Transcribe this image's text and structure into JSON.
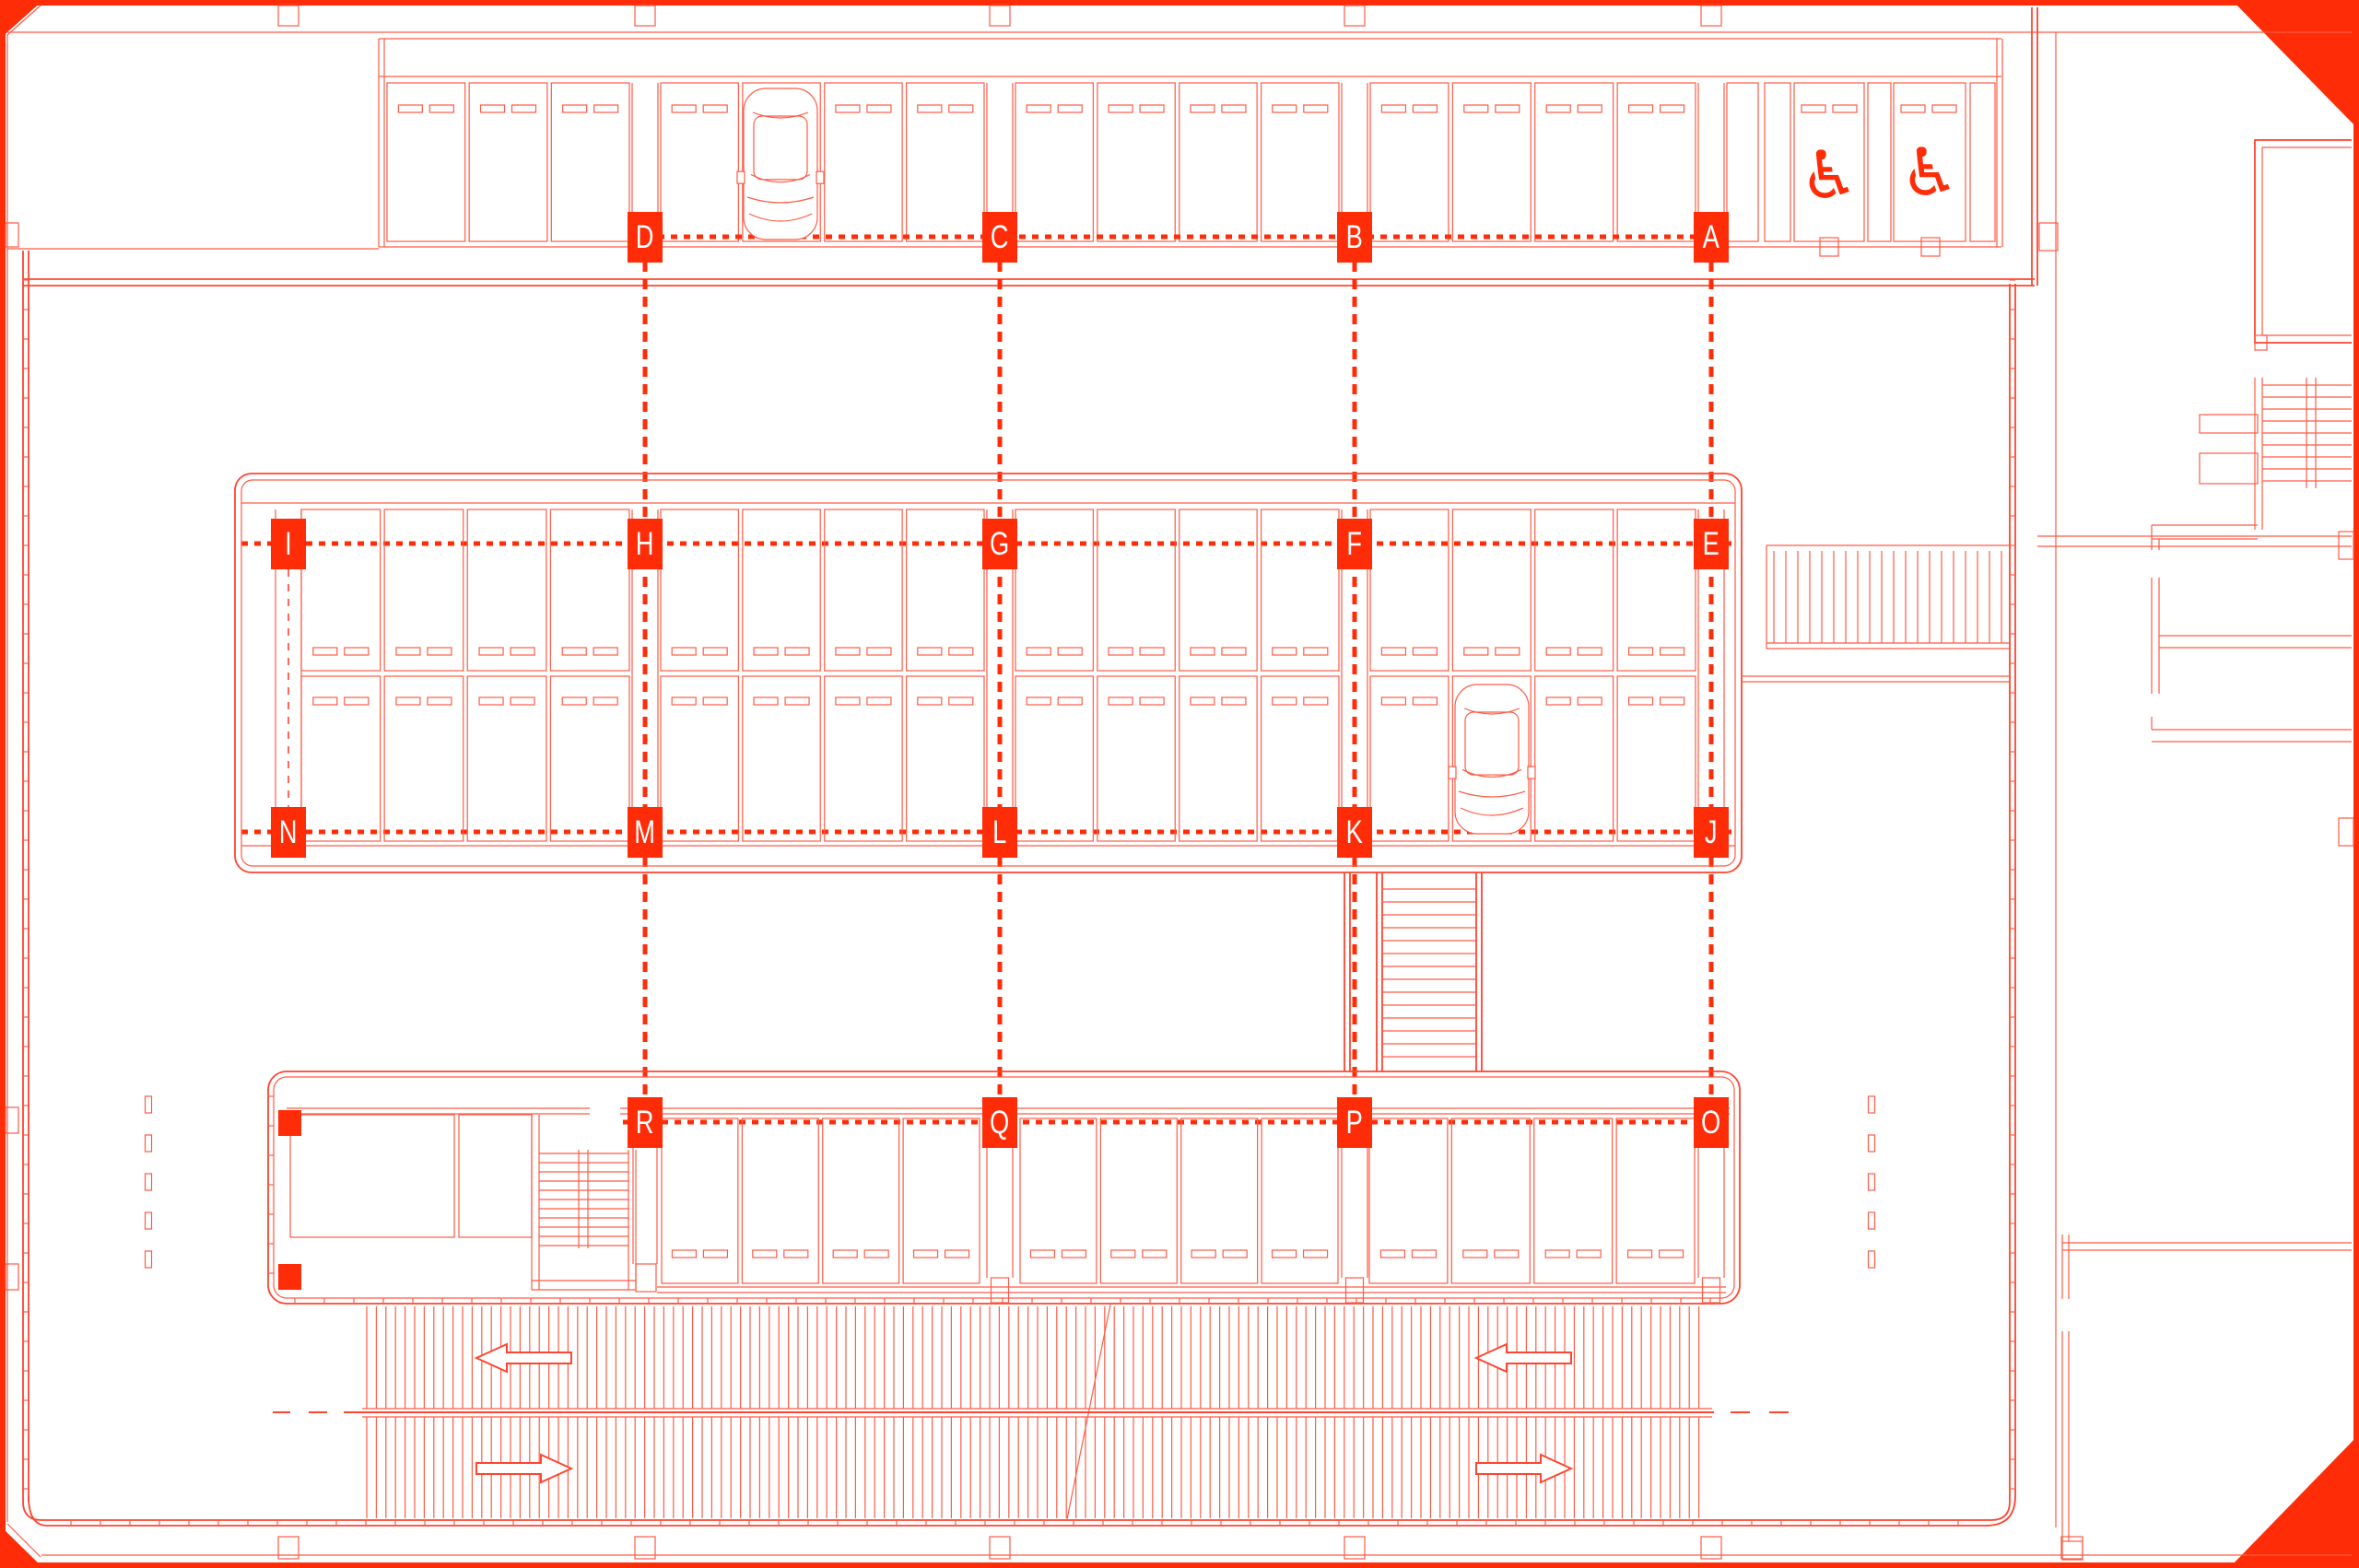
{
  "document": {
    "type": "parking-garage-floor-plan",
    "description": "Red line architectural plan of a parking level on a drawing sheet with cut corners"
  },
  "palette": {
    "background": "#ffffff",
    "thin_line": "#ff5b45",
    "wall_line": "#ff4430",
    "accent_fill": "#ff2c08"
  },
  "grid": {
    "rows": [
      {
        "name": "row-1",
        "labels": [
          "D",
          "C",
          "B",
          "A"
        ]
      },
      {
        "name": "row-2",
        "labels": [
          "I",
          "H",
          "G",
          "F",
          "E"
        ]
      },
      {
        "name": "row-3",
        "labels": [
          "N",
          "M",
          "L",
          "K",
          "J"
        ]
      },
      {
        "name": "row-4",
        "labels": [
          "R",
          "Q",
          "P",
          "O"
        ]
      }
    ]
  },
  "markers": [
    {
      "label": "D",
      "col": 1,
      "row": 0
    },
    {
      "label": "C",
      "col": 2,
      "row": 0
    },
    {
      "label": "B",
      "col": 3,
      "row": 0
    },
    {
      "label": "A",
      "col": 4,
      "row": 0
    },
    {
      "label": "I",
      "col": 0,
      "row": 1
    },
    {
      "label": "H",
      "col": 1,
      "row": 1
    },
    {
      "label": "G",
      "col": 2,
      "row": 1
    },
    {
      "label": "F",
      "col": 3,
      "row": 1
    },
    {
      "label": "E",
      "col": 4,
      "row": 1
    },
    {
      "label": "N",
      "col": 0,
      "row": 2
    },
    {
      "label": "M",
      "col": 1,
      "row": 2
    },
    {
      "label": "L",
      "col": 2,
      "row": 2
    },
    {
      "label": "K",
      "col": 3,
      "row": 2
    },
    {
      "label": "J",
      "col": 4,
      "row": 2
    },
    {
      "label": "R",
      "col": 1,
      "row": 3
    },
    {
      "label": "Q",
      "col": 2,
      "row": 3
    },
    {
      "label": "P",
      "col": 3,
      "row": 3
    },
    {
      "label": "O",
      "col": 4,
      "row": 3
    }
  ],
  "icons": {
    "wheelchair_glyph": "♿"
  },
  "symbols": {
    "cars_drawn": 2,
    "accessible_stalls": 2,
    "ramp_upper_lane_arrow": "left",
    "ramp_lower_lane_arrow": "right"
  }
}
